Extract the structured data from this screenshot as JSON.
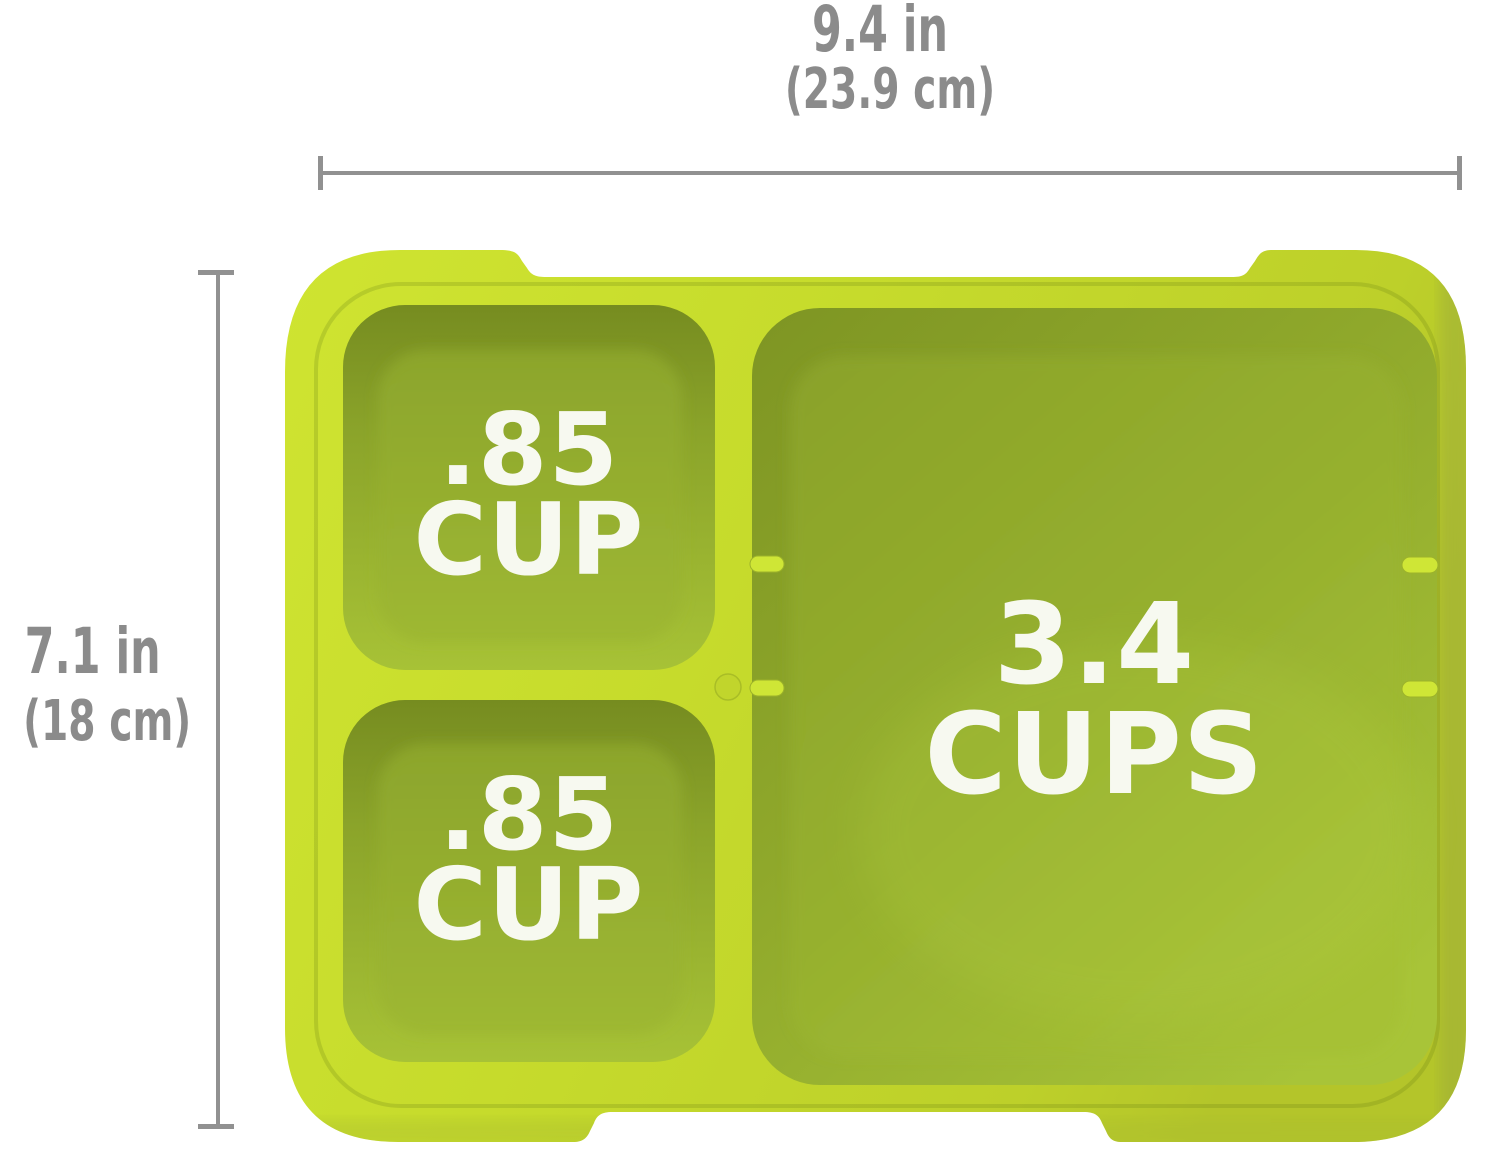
{
  "diagram": {
    "title": "bento tray dimension diagram",
    "width_dimension": {
      "value_in": "9.4 in",
      "value_cm": "(23.9 cm)"
    },
    "height_dimension": {
      "value_in": "7.1 in",
      "value_cm": "(18 cm)"
    },
    "compartments": {
      "top_small": {
        "line1": ".85",
        "line2": "CUP"
      },
      "bottom_small": {
        "line1": ".85",
        "line2": "CUP"
      },
      "large": {
        "line1": "3.4",
        "line2": "CUPS"
      }
    },
    "colors": {
      "background": "#ffffff",
      "tray_rim": "#c6db2c",
      "tray_rim_highlight": "#cfe431",
      "well_wall_shadow": "#768c20",
      "well_floor": "#9cb531",
      "capacity_text": "#f7f9f0",
      "dimension_text": "#8b8b8b",
      "dimension_line": "#919191"
    }
  }
}
